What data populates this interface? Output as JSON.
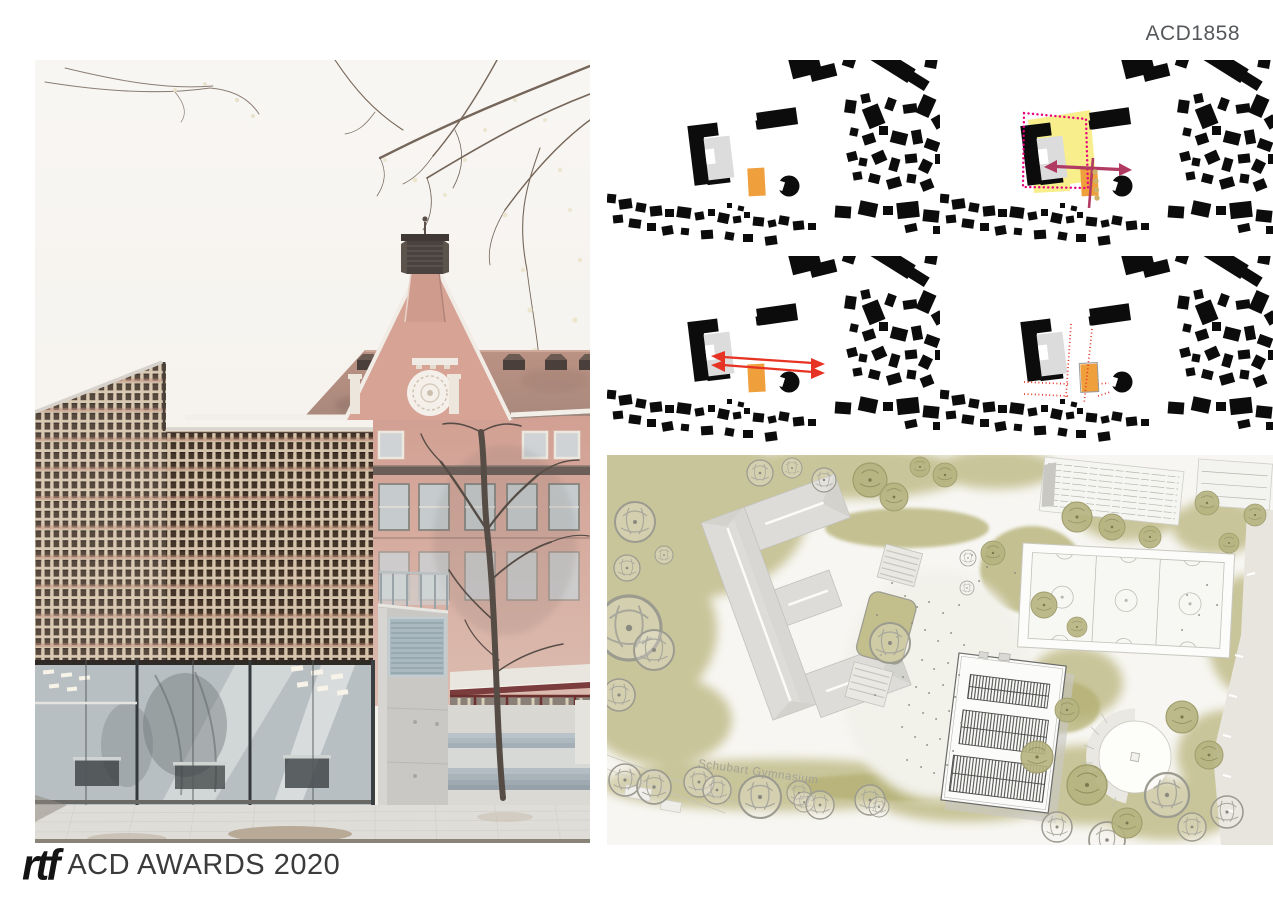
{
  "header": {
    "code": "ACD1858"
  },
  "footer": {
    "logo": "rtf",
    "title": "ACD AWARDS 2020"
  },
  "site_plan": {
    "label": "Schubart Gymnasium"
  },
  "palette": {
    "accent_orange": "#EFA03C",
    "highlight_yellow": "#F8EE8C",
    "magenta_dotted": "#E6007E",
    "dark_pink_arrow": "#B03A62",
    "signal_red": "#E63323",
    "figure_black": "#0C0C0C",
    "existing_gray": "#DCDCDC",
    "landscape_green": "#C9C59A",
    "roof_terracotta": "#B68C7F",
    "wall_rose": "#D3A093",
    "facade_tan": "#D5C3AB",
    "facade_window_dark": "#453528",
    "glass_blue_gray": "#B7BFC2",
    "concrete_gray": "#C9C8C4"
  }
}
